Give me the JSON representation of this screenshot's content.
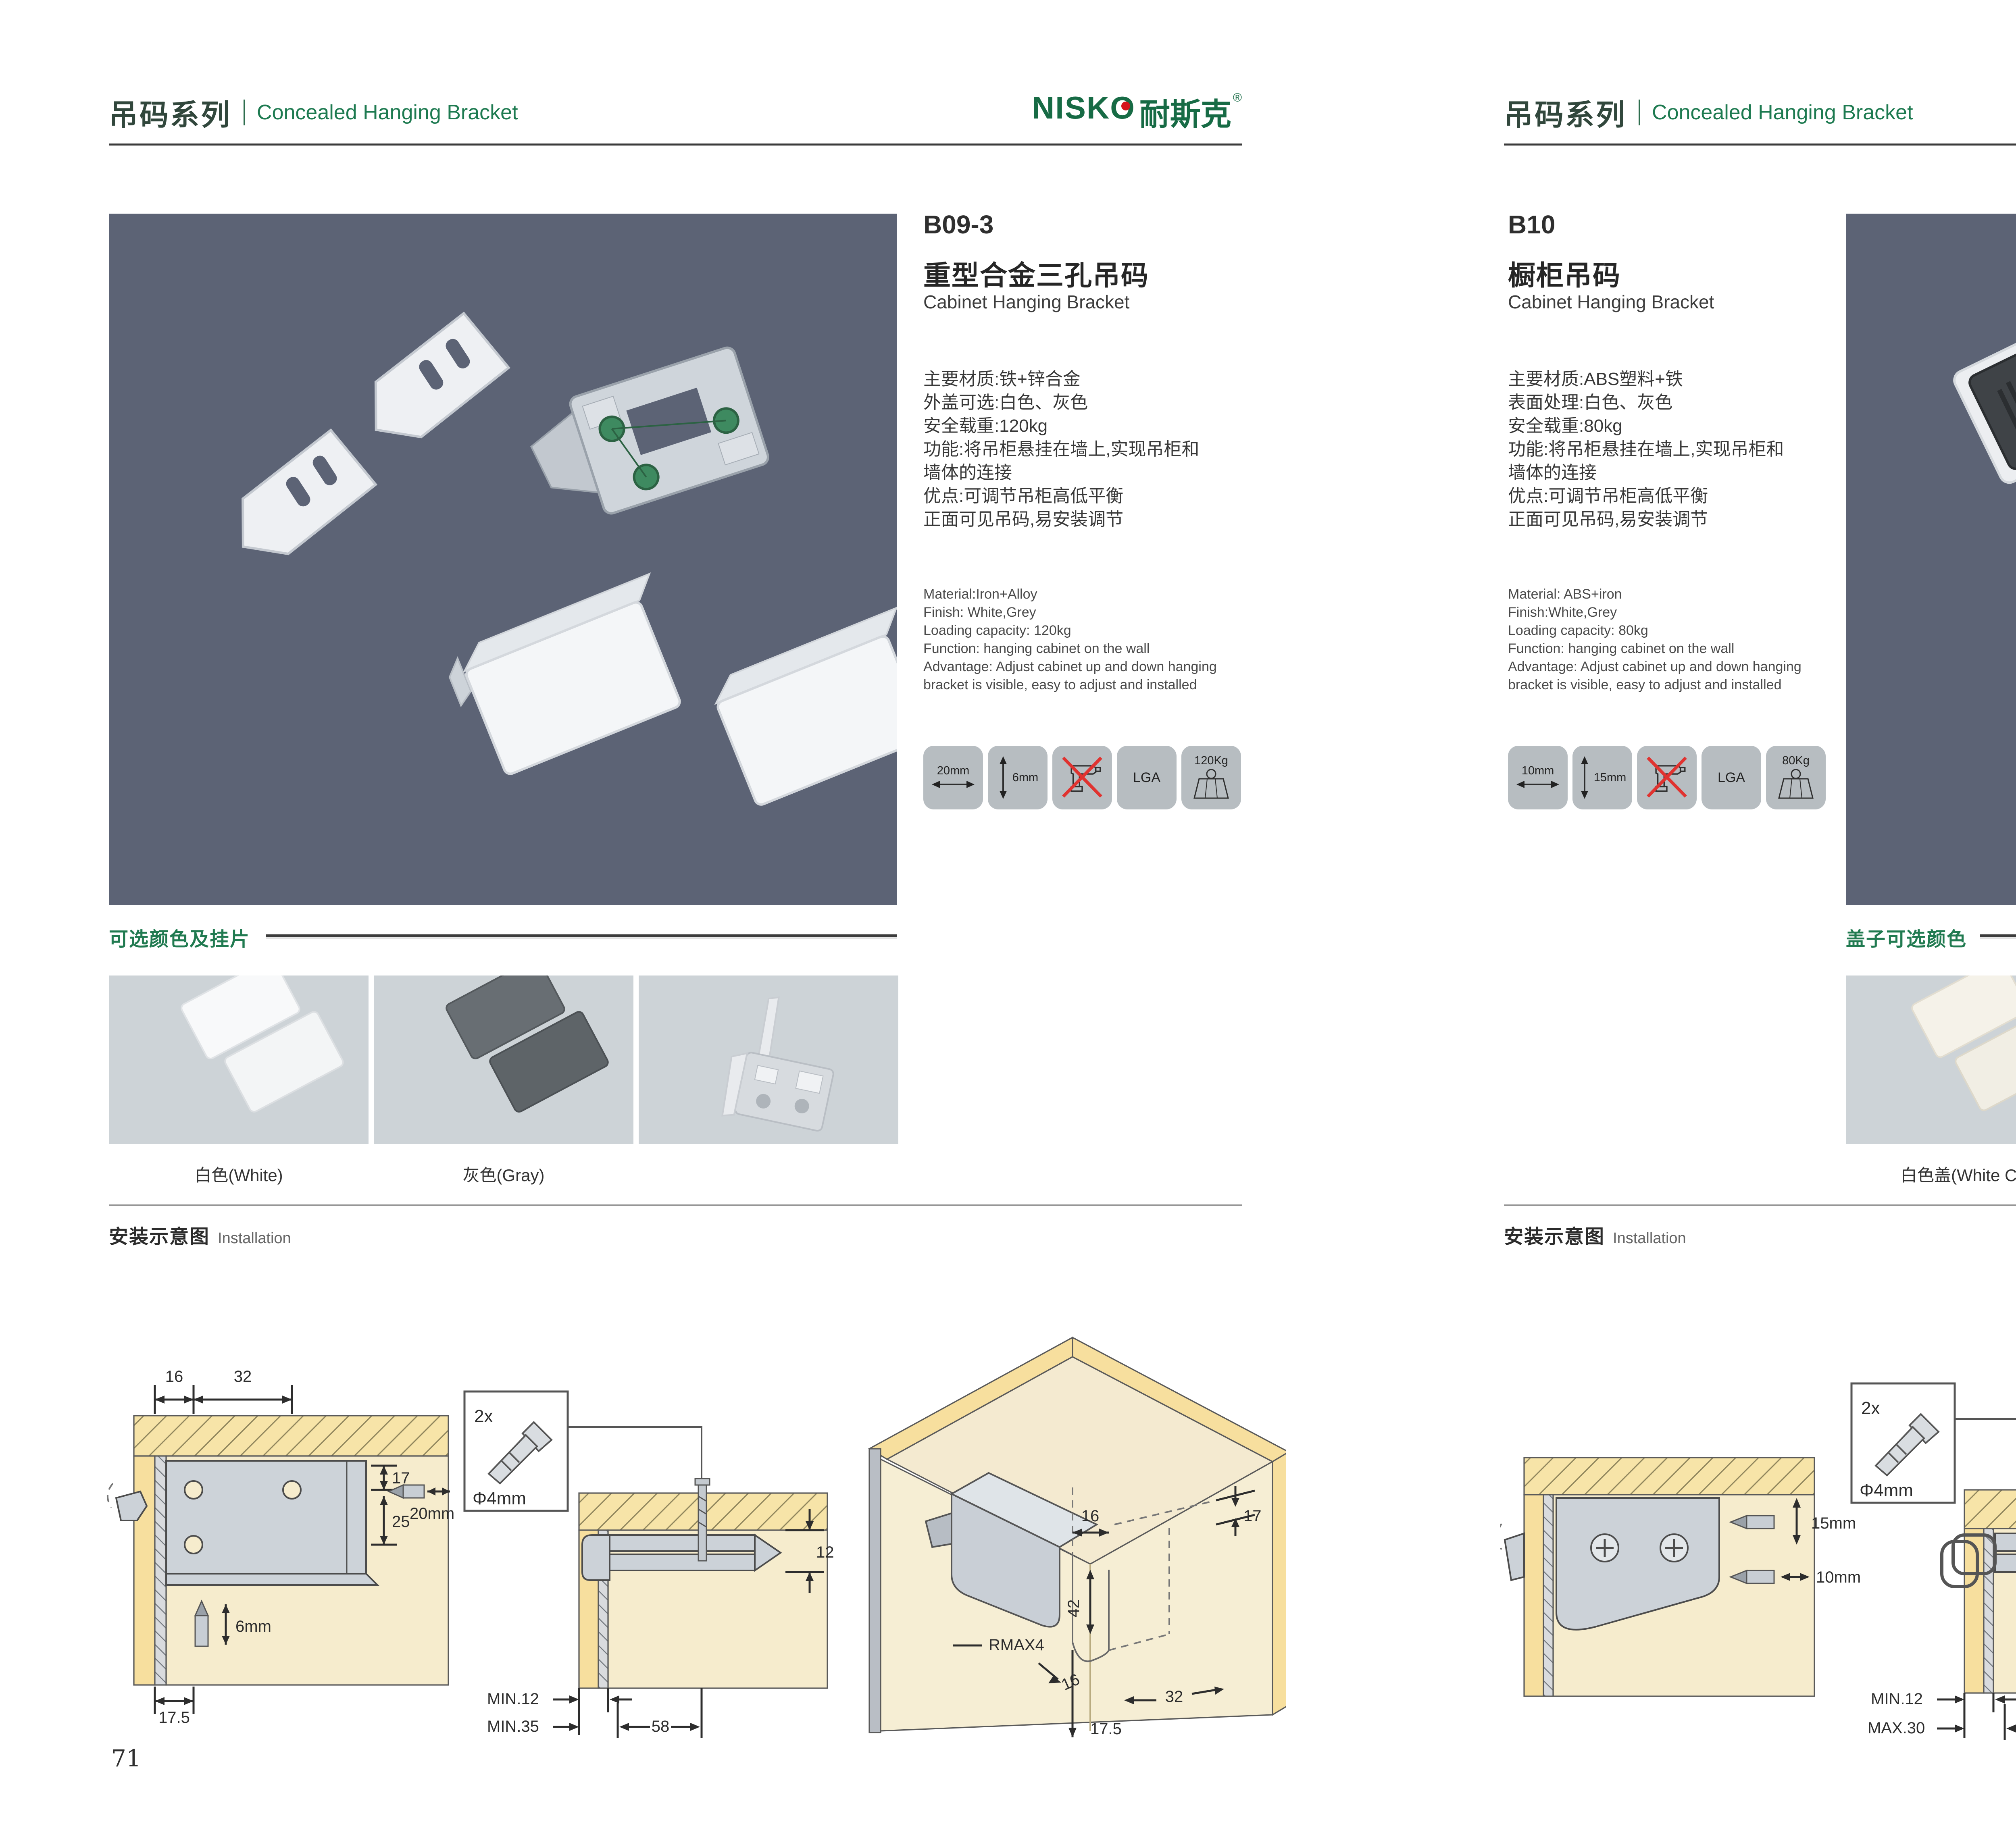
{
  "brand": {
    "name_latin": "NISKO",
    "name_cjk": "耐斯克",
    "reg": "®"
  },
  "colors_theme": {
    "accent_green": "#1d7a50",
    "logo_green": "#176b45",
    "logo_red": "#d6131c",
    "photo_bg": "#5c6375",
    "swatch_bg": "#cdd3d7",
    "tile_bg": "#b7bdc1",
    "wood_yellow": "#f7df9e",
    "panel_beige": "#f6eccd",
    "warning_red": "#e03330"
  },
  "pages": [
    {
      "number": "71",
      "header": {
        "series": "吊码系列",
        "subtitle": "Concealed Hanging Bracket"
      },
      "product": {
        "code": "B09-3",
        "title_cn": "重型合金三孔吊码",
        "title_en": "Cabinet Hanging Bracket",
        "specs_cn": [
          "主要材质:铁+锌合金",
          "外盖可选:白色、灰色",
          "安全载重:120kg",
          "功能:将吊柜悬挂在墙上,实现吊柜和",
          "墙体的连接",
          "优点:可调节吊柜高低平衡",
          "正面可见吊码,易安装调节"
        ],
        "specs_en": [
          "Material:Iron+Alloy",
          "Finish: White,Grey",
          "Loading capacity: 120kg",
          "Function: hanging cabinet on the wall",
          "Advantage: Adjust cabinet up and down hanging",
          "bracket is visible, easy to adjust and installed"
        ],
        "icons": {
          "width": "20mm",
          "height": "6mm",
          "cert": "LGA",
          "weight": "120Kg"
        }
      },
      "colors": {
        "title": "可选颜色及挂片",
        "labels": [
          "白色(White)",
          "灰色(Gray)",
          ""
        ]
      },
      "install": {
        "title_cn": "安装示意图",
        "title_en": "Installation",
        "d1": {
          "top1": "16",
          "top2": "32",
          "r1": "17",
          "r2": "25",
          "bit_h": "20mm",
          "bit_v": "6mm",
          "bottom": "17.5"
        },
        "d2": {
          "qty": "2x",
          "dia": "Φ4mm",
          "right": "12",
          "b1": "MIN.12",
          "b2": "MIN.35",
          "b3": "58"
        },
        "d3": {
          "t1": "16",
          "r1": "17",
          "v1": "42",
          "rmax": "RMAX4",
          "b1": "16",
          "b2": "32",
          "b3": "17.5"
        }
      }
    },
    {
      "number": "72",
      "header": {
        "series": "吊码系列",
        "subtitle": "Concealed Hanging Bracket"
      },
      "product": {
        "code": "B10",
        "title_cn": "橱柜吊码",
        "title_en": "Cabinet Hanging Bracket",
        "specs_cn": [
          "主要材质:ABS塑料+铁",
          "表面处理:白色、灰色",
          "安全载重:80kg",
          "功能:将吊柜悬挂在墙上,实现吊柜和",
          "墙体的连接",
          "优点:可调节吊柜高低平衡",
          "正面可见吊码,易安装调节"
        ],
        "specs_en": [
          "Material: ABS+iron",
          "Finish:White,Grey",
          "Loading capacity: 80kg",
          "Function: hanging cabinet on the wall",
          "Advantage: Adjust cabinet up and down hanging",
          "bracket is visible, easy to adjust and installed"
        ],
        "icons": {
          "width": "10mm",
          "height": "15mm",
          "cert": "LGA",
          "weight": "80Kg"
        }
      },
      "colors": {
        "title": "盖子可选颜色",
        "labels": [
          "白色盖(White Cap)",
          "灰色盖(Gray Cap)"
        ]
      },
      "install": {
        "title_cn": "安装示意图",
        "title_en": "Installation",
        "d1": {
          "v": "15mm",
          "h": "10mm"
        },
        "d2": {
          "qty": "2x",
          "dia": "Φ4mm",
          "right": "18",
          "b1": "MIN.12",
          "b2": "MAX.30",
          "b3": "67"
        },
        "d3": {
          "t1": "13",
          "v1": "42",
          "rmax": "RMAX4",
          "b1": "19",
          "b2": "17",
          "b3": "32"
        }
      }
    }
  ]
}
